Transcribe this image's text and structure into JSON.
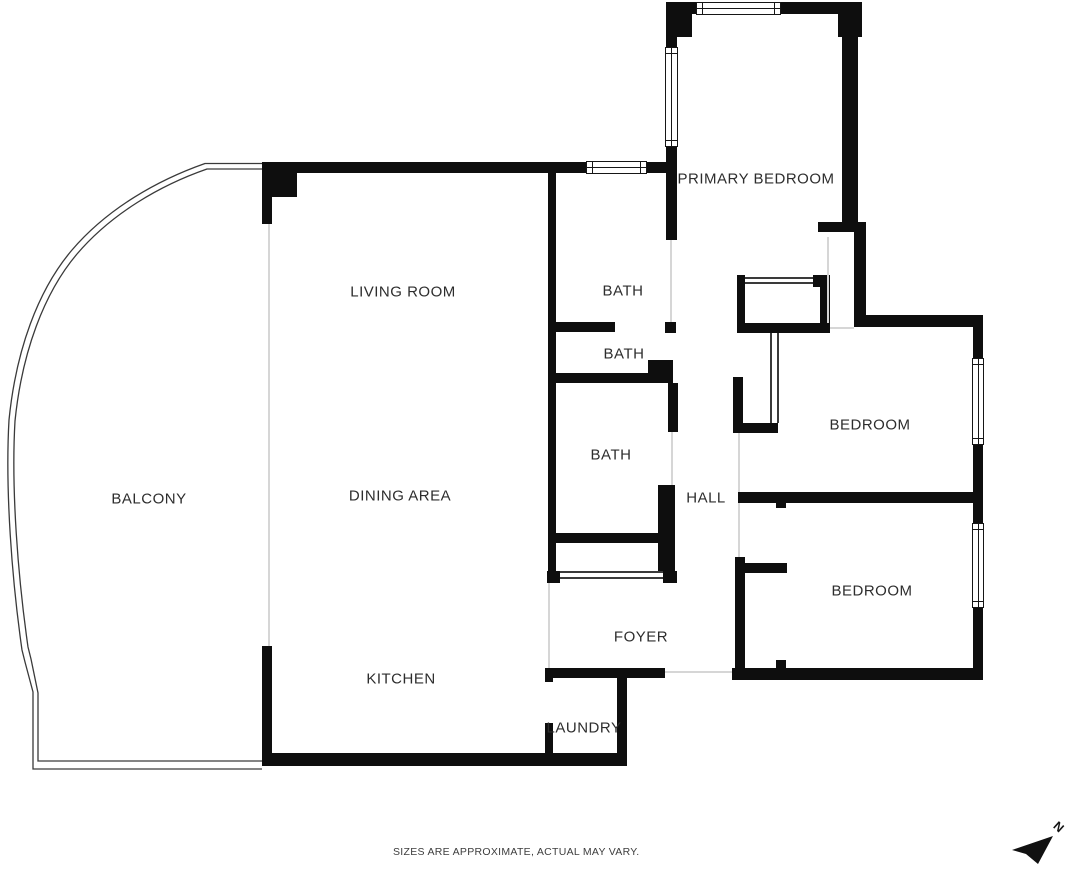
{
  "meta": {
    "canvas_width": 1072,
    "canvas_height": 872,
    "background_color": "#ffffff",
    "wall_color": "#0e0e0e",
    "label_color": "#2d2d2d",
    "faint_line_color": "#d6d6d6",
    "detail_line_color": "#3a3a3a"
  },
  "rooms": [
    {
      "id": "living-room",
      "label": "LIVING ROOM",
      "x": 403,
      "y": 292
    },
    {
      "id": "dining-area",
      "label": "DINING AREA",
      "x": 400,
      "y": 496
    },
    {
      "id": "kitchen",
      "label": "KITCHEN",
      "x": 401,
      "y": 679
    },
    {
      "id": "balcony",
      "label": "BALCONY",
      "x": 149,
      "y": 499
    },
    {
      "id": "primary-bedroom",
      "label": "PRIMARY BEDROOM",
      "x": 756,
      "y": 179
    },
    {
      "id": "bath-1",
      "label": "BATH",
      "x": 623,
      "y": 291
    },
    {
      "id": "bath-2",
      "label": "BATH",
      "x": 624,
      "y": 354
    },
    {
      "id": "bath-3",
      "label": "BATH",
      "x": 611,
      "y": 455
    },
    {
      "id": "hall",
      "label": "HALL",
      "x": 706,
      "y": 498
    },
    {
      "id": "bedroom-1",
      "label": "BEDROOM",
      "x": 870,
      "y": 425
    },
    {
      "id": "bedroom-2",
      "label": "BEDROOM",
      "x": 872,
      "y": 591
    },
    {
      "id": "foyer",
      "label": "FOYER",
      "x": 641,
      "y": 637
    },
    {
      "id": "laundry",
      "label": "LAUNDRY",
      "x": 584,
      "y": 728
    }
  ],
  "walls": [
    [
      262,
      162,
      324,
      11
    ],
    [
      647,
      162,
      19,
      11
    ],
    [
      262,
      162,
      35,
      35
    ],
    [
      262,
      162,
      10,
      62
    ],
    [
      666,
      2,
      31,
      12
    ],
    [
      780,
      2,
      78,
      12
    ],
    [
      666,
      2,
      26,
      35
    ],
    [
      838,
      2,
      24,
      35
    ],
    [
      666,
      2,
      11,
      45
    ],
    [
      666,
      147,
      11,
      93
    ],
    [
      842,
      2,
      16,
      220
    ],
    [
      818,
      222,
      48,
      10
    ],
    [
      854,
      232,
      12,
      95
    ],
    [
      854,
      315,
      129,
      12
    ],
    [
      973,
      327,
      10,
      32
    ],
    [
      973,
      445,
      10,
      58
    ],
    [
      738,
      492,
      245,
      11
    ],
    [
      973,
      503,
      10,
      21
    ],
    [
      973,
      608,
      10,
      72
    ],
    [
      732,
      668,
      251,
      12
    ],
    [
      548,
      173,
      8,
      410
    ],
    [
      548,
      322,
      67,
      10
    ],
    [
      665,
      322,
      11,
      11
    ],
    [
      556,
      373,
      92,
      10
    ],
    [
      648,
      360,
      25,
      23
    ],
    [
      668,
      383,
      10,
      49
    ],
    [
      658,
      485,
      17,
      86
    ],
    [
      555,
      533,
      103,
      10
    ],
    [
      547,
      571,
      13,
      12
    ],
    [
      663,
      571,
      14,
      12
    ],
    [
      737,
      275,
      8,
      58
    ],
    [
      813,
      275,
      17,
      12
    ],
    [
      820,
      287,
      10,
      46
    ],
    [
      737,
      323,
      93,
      10
    ],
    [
      733,
      377,
      10,
      56
    ],
    [
      743,
      423,
      35,
      10
    ],
    [
      735,
      557,
      10,
      123
    ],
    [
      745,
      563,
      42,
      10
    ],
    [
      776,
      500,
      10,
      8
    ],
    [
      776,
      660,
      10,
      8
    ],
    [
      262,
      646,
      10,
      110
    ],
    [
      262,
      753,
      365,
      13
    ],
    [
      545,
      668,
      120,
      10
    ],
    [
      545,
      668,
      8,
      14
    ],
    [
      545,
      723,
      8,
      34
    ],
    [
      617,
      677,
      10,
      89
    ]
  ],
  "windows": [
    {
      "rect": [
        586,
        161,
        61,
        13
      ],
      "orientation": "h",
      "name": "bath-exterior-window"
    },
    {
      "rect": [
        696,
        2,
        85,
        13
      ],
      "orientation": "h",
      "name": "primary-bedroom-top-window"
    },
    {
      "rect": [
        665,
        47,
        13,
        100
      ],
      "orientation": "v",
      "name": "primary-bedroom-side-window"
    },
    {
      "rect": [
        972,
        358,
        12,
        87
      ],
      "orientation": "v",
      "name": "bedroom-1-window"
    },
    {
      "rect": [
        972,
        523,
        12,
        85
      ],
      "orientation": "v",
      "name": "bedroom-2-window"
    }
  ],
  "faint_lines": [
    [
      268,
      224,
      2,
      422
    ],
    [
      670,
      240,
      2,
      82
    ],
    [
      671,
      432,
      2,
      53
    ],
    [
      738,
      433,
      2,
      59
    ],
    [
      738,
      503,
      2,
      54
    ],
    [
      830,
      327,
      24,
      2
    ],
    [
      827,
      237,
      2,
      86
    ],
    [
      665,
      671,
      67,
      2
    ],
    [
      548,
      583,
      2,
      85
    ]
  ],
  "detail_lines": [
    [
      745,
      277,
      68,
      2
    ],
    [
      745,
      282,
      68,
      2
    ],
    [
      770,
      333,
      2,
      90
    ],
    [
      777,
      333,
      2,
      90
    ],
    [
      560,
      571,
      103,
      2
    ],
    [
      560,
      577,
      103,
      2
    ]
  ],
  "balcony": {
    "outer_path": "M265,163.5 L205,163.5 C158,180 108,208 72,250 C38,290 16,350 9,420 C5,490 12,580 22,650 L25,662 L33,692 L33,769 L262,769",
    "inner_path": "M265,169 L207,169 C161,185 112,213 77,254 C44,293 22,352 15,421 C11,489 18,577 28,647 L31,659 L38,693 L38,761 L262,761"
  },
  "north_arrow": {
    "label": "N",
    "points": "48,18 7,32 21,36 33,46"
  },
  "footer": {
    "text": "SIZES ARE APPROXIMATE, ACTUAL MAY VARY."
  }
}
